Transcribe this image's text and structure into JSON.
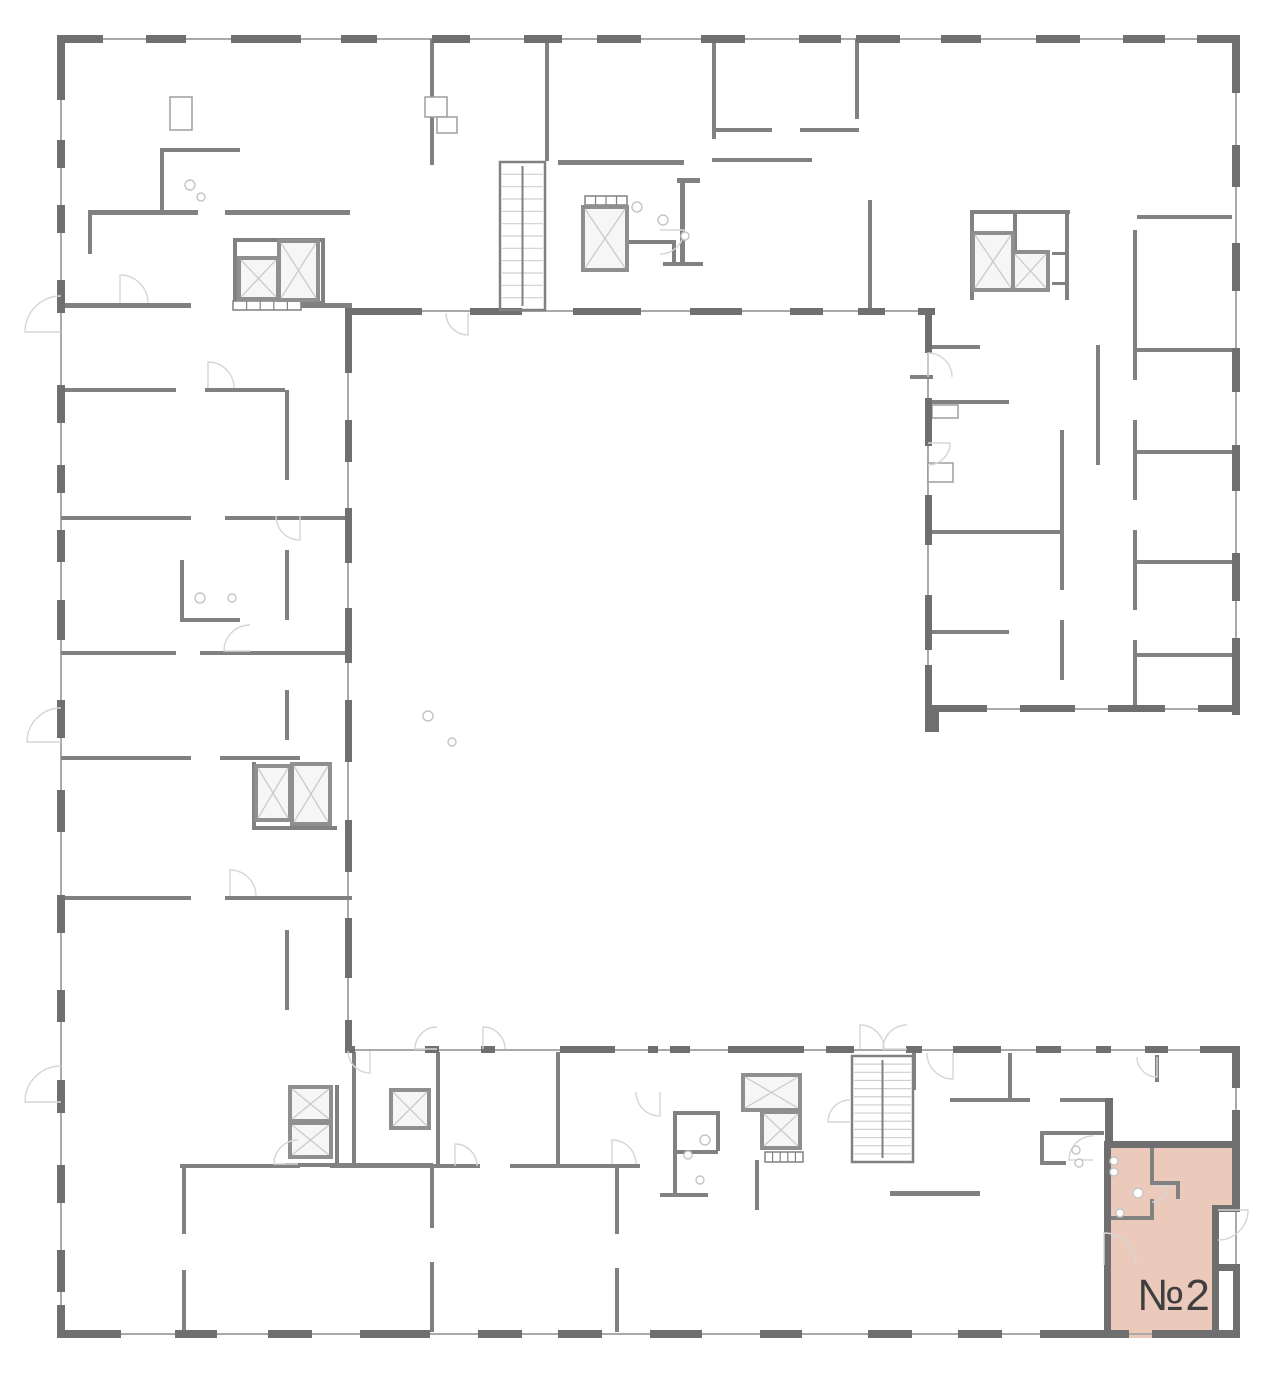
{
  "canvas": {
    "w": 1280,
    "h": 1374
  },
  "colors": {
    "bg": "#ffffff",
    "wall_dark": "#6f6f6f",
    "wall_medium": "#818181",
    "thin_line": "#a9a9a9",
    "arc": "#d6d6d6",
    "shaft_border": "#8f8f8f",
    "shaft_fill": "#f6f6f6",
    "shaft_x": "#cbcbcb",
    "box_line": "#9d9d9d",
    "tread": "#cfcfcf",
    "fixture": "#c4c4c4",
    "highlight_fill": "#ebcabc",
    "label_color": "#3f3f3f"
  },
  "unit": {
    "label": "№2",
    "polygon_points": "1104,1141 1240,1141 1240,1212 1216,1212 1216,1338 1104,1338",
    "label_x": 1174,
    "label_y": 1310,
    "font_size": 44
  },
  "thin_lines": [
    [
      57,
      39,
      1240,
      39
    ],
    [
      61,
      35,
      61,
      1338
    ],
    [
      57,
      1334,
      1240,
      1334
    ],
    [
      1236,
      35,
      1236,
      712
    ],
    [
      925,
      709,
      1240,
      709
    ],
    [
      348,
      308,
      348,
      1052
    ],
    [
      352,
      311,
      932,
      311
    ],
    [
      928,
      308,
      928,
      712
    ],
    [
      345,
      1050,
      1240,
      1050
    ],
    [
      1236,
      1046,
      1236,
      1338
    ]
  ],
  "dark_walls": [
    [
      57,
      35,
      46,
      8
    ],
    [
      146,
      35,
      40,
      8
    ],
    [
      231,
      35,
      70,
      8
    ],
    [
      341,
      35,
      36,
      8
    ],
    [
      432,
      35,
      38,
      8
    ],
    [
      524,
      35,
      38,
      8
    ],
    [
      597,
      35,
      44,
      8
    ],
    [
      701,
      35,
      44,
      8
    ],
    [
      799,
      35,
      42,
      8
    ],
    [
      856,
      35,
      44,
      8
    ],
    [
      941,
      35,
      40,
      8
    ],
    [
      1036,
      35,
      44,
      8
    ],
    [
      1123,
      35,
      42,
      8
    ],
    [
      1197,
      35,
      43,
      8
    ],
    [
      57,
      35,
      8,
      65
    ],
    [
      57,
      140,
      8,
      28
    ],
    [
      57,
      205,
      8,
      28
    ],
    [
      57,
      280,
      8,
      33
    ],
    [
      57,
      385,
      8,
      38
    ],
    [
      57,
      465,
      8,
      28
    ],
    [
      57,
      530,
      8,
      32
    ],
    [
      57,
      600,
      8,
      40
    ],
    [
      57,
      700,
      8,
      38
    ],
    [
      57,
      790,
      8,
      42
    ],
    [
      57,
      895,
      8,
      38
    ],
    [
      57,
      990,
      8,
      32
    ],
    [
      57,
      1080,
      8,
      33
    ],
    [
      57,
      1165,
      8,
      38
    ],
    [
      57,
      1250,
      8,
      42
    ],
    [
      57,
      1305,
      8,
      33
    ],
    [
      57,
      1330,
      64,
      8
    ],
    [
      175,
      1330,
      42,
      8
    ],
    [
      268,
      1330,
      44,
      8
    ],
    [
      360,
      1330,
      70,
      8
    ],
    [
      478,
      1330,
      44,
      8
    ],
    [
      558,
      1330,
      44,
      8
    ],
    [
      650,
      1330,
      52,
      8
    ],
    [
      760,
      1330,
      42,
      8
    ],
    [
      868,
      1330,
      44,
      8
    ],
    [
      958,
      1330,
      44,
      8
    ],
    [
      1040,
      1330,
      64,
      8
    ],
    [
      1104,
      1330,
      25,
      8
    ],
    [
      1152,
      1330,
      64,
      8
    ],
    [
      1216,
      1330,
      24,
      8
    ],
    [
      1232,
      35,
      8,
      58
    ],
    [
      1232,
      145,
      8,
      42
    ],
    [
      1232,
      243,
      8,
      48
    ],
    [
      1232,
      348,
      8,
      44
    ],
    [
      1232,
      445,
      8,
      46
    ],
    [
      1232,
      553,
      8,
      48
    ],
    [
      1232,
      638,
      8,
      77
    ],
    [
      925,
      705,
      62,
      7
    ],
    [
      1020,
      705,
      55,
      7
    ],
    [
      1108,
      705,
      57,
      7
    ],
    [
      1198,
      705,
      42,
      7
    ],
    [
      925,
      705,
      14,
      27
    ],
    [
      352,
      308,
      70,
      7
    ],
    [
      470,
      308,
      52,
      7
    ],
    [
      573,
      308,
      68,
      7
    ],
    [
      690,
      308,
      52,
      7
    ],
    [
      790,
      308,
      33,
      7
    ],
    [
      858,
      308,
      27,
      7
    ],
    [
      918,
      308,
      17,
      7
    ],
    [
      345,
      308,
      7,
      65
    ],
    [
      345,
      420,
      7,
      42
    ],
    [
      345,
      508,
      7,
      55
    ],
    [
      345,
      608,
      7,
      55
    ],
    [
      345,
      700,
      7,
      62
    ],
    [
      345,
      820,
      7,
      52
    ],
    [
      345,
      918,
      7,
      60
    ],
    [
      345,
      1020,
      7,
      32
    ],
    [
      925,
      308,
      7,
      45
    ],
    [
      925,
      398,
      7,
      48
    ],
    [
      925,
      495,
      7,
      50
    ],
    [
      925,
      595,
      7,
      55
    ],
    [
      925,
      665,
      7,
      47
    ],
    [
      345,
      1046,
      10,
      7
    ],
    [
      425,
      1046,
      14,
      7
    ],
    [
      481,
      1046,
      14,
      7
    ],
    [
      560,
      1046,
      55,
      7
    ],
    [
      648,
      1046,
      10,
      7
    ],
    [
      670,
      1046,
      20,
      7
    ],
    [
      728,
      1046,
      76,
      7
    ],
    [
      826,
      1046,
      28,
      7
    ],
    [
      906,
      1046,
      16,
      7
    ],
    [
      953,
      1046,
      48,
      7
    ],
    [
      1036,
      1046,
      25,
      7
    ],
    [
      1096,
      1046,
      15,
      7
    ],
    [
      1145,
      1046,
      23,
      7
    ],
    [
      1200,
      1046,
      38,
      7
    ],
    [
      1232,
      1046,
      8,
      42
    ],
    [
      1232,
      1110,
      8,
      31
    ],
    [
      1232,
      1141,
      8,
      68
    ],
    [
      1233,
      1264,
      7,
      74
    ],
    [
      1104,
      1141,
      7,
      197
    ],
    [
      1104,
      1141,
      136,
      7
    ],
    [
      1216,
      1205,
      24,
      7
    ],
    [
      1212,
      1205,
      7,
      133
    ],
    [
      1216,
      1264,
      22,
      7
    ],
    [
      1105,
      1098,
      8,
      47
    ]
  ],
  "medium_walls": [
    [
      430,
      39,
      4,
      126
    ],
    [
      545,
      39,
      4,
      122
    ],
    [
      558,
      160,
      126,
      5
    ],
    [
      680,
      178,
      5,
      84
    ],
    [
      677,
      178,
      23,
      5
    ],
    [
      663,
      262,
      40,
      4
    ],
    [
      672,
      240,
      4,
      24
    ],
    [
      625,
      240,
      48,
      4
    ],
    [
      712,
      39,
      4,
      100
    ],
    [
      712,
      128,
      60,
      4
    ],
    [
      800,
      128,
      59,
      4
    ],
    [
      712,
      158,
      100,
      4
    ],
    [
      855,
      39,
      4,
      80
    ],
    [
      868,
      200,
      4,
      110
    ],
    [
      88,
      210,
      110,
      5
    ],
    [
      225,
      210,
      125,
      5
    ],
    [
      88,
      210,
      4,
      44
    ],
    [
      160,
      148,
      80,
      4
    ],
    [
      160,
      148,
      4,
      64
    ],
    [
      61,
      303,
      130,
      5
    ],
    [
      248,
      303,
      104,
      5
    ],
    [
      61,
      388,
      115,
      4
    ],
    [
      205,
      388,
      80,
      4
    ],
    [
      61,
      516,
      130,
      4
    ],
    [
      225,
      516,
      127,
      4
    ],
    [
      61,
      651,
      115,
      4
    ],
    [
      200,
      651,
      152,
      4
    ],
    [
      61,
      756,
      130,
      4
    ],
    [
      220,
      756,
      80,
      4
    ],
    [
      61,
      896,
      130,
      4
    ],
    [
      225,
      896,
      127,
      4
    ],
    [
      285,
      390,
      4,
      90
    ],
    [
      285,
      550,
      4,
      70
    ],
    [
      285,
      690,
      4,
      50
    ],
    [
      285,
      930,
      4,
      80
    ],
    [
      233,
      238,
      90,
      4
    ],
    [
      233,
      238,
      4,
      67
    ],
    [
      321,
      238,
      4,
      67
    ],
    [
      233,
      301,
      90,
      4
    ],
    [
      252,
      762,
      4,
      66
    ],
    [
      252,
      826,
      85,
      4
    ],
    [
      180,
      560,
      4,
      60
    ],
    [
      180,
      618,
      60,
      4
    ],
    [
      932,
      345,
      48,
      4
    ],
    [
      910,
      375,
      23,
      4
    ],
    [
      929,
      400,
      80,
      4
    ],
    [
      929,
      530,
      131,
      4
    ],
    [
      929,
      630,
      80,
      4
    ],
    [
      1060,
      430,
      4,
      160
    ],
    [
      1060,
      620,
      4,
      60
    ],
    [
      1096,
      345,
      4,
      120
    ],
    [
      1133,
      230,
      4,
      150
    ],
    [
      1133,
      420,
      4,
      80
    ],
    [
      1133,
      530,
      4,
      80
    ],
    [
      1133,
      640,
      4,
      72
    ],
    [
      1137,
      215,
      95,
      4
    ],
    [
      1137,
      348,
      95,
      4
    ],
    [
      1137,
      450,
      95,
      4
    ],
    [
      1137,
      560,
      95,
      4
    ],
    [
      1137,
      653,
      95,
      4
    ],
    [
      970,
      210,
      100,
      4
    ],
    [
      970,
      210,
      4,
      90
    ],
    [
      1065,
      210,
      4,
      90
    ],
    [
      1013,
      210,
      4,
      40
    ],
    [
      1052,
      252,
      14,
      3
    ],
    [
      1052,
      282,
      14,
      3
    ],
    [
      352,
      1052,
      4,
      114
    ],
    [
      436,
      1052,
      4,
      114
    ],
    [
      556,
      1052,
      4,
      114
    ],
    [
      180,
      1164,
      120,
      4
    ],
    [
      330,
      1164,
      150,
      4
    ],
    [
      510,
      1164,
      130,
      4
    ],
    [
      182,
      1164,
      4,
      70
    ],
    [
      182,
      1270,
      4,
      62
    ],
    [
      430,
      1168,
      4,
      60
    ],
    [
      430,
      1262,
      4,
      70
    ],
    [
      615,
      1164,
      4,
      70
    ],
    [
      615,
      1268,
      4,
      64
    ],
    [
      673,
      1111,
      45,
      4
    ],
    [
      673,
      1111,
      4,
      86
    ],
    [
      673,
      1150,
      45,
      4
    ],
    [
      660,
      1193,
      48,
      4
    ],
    [
      716,
      1111,
      4,
      40
    ],
    [
      755,
      1160,
      4,
      50
    ],
    [
      890,
      1191,
      90,
      5
    ],
    [
      912,
      1053,
      4,
      37
    ],
    [
      335,
      1085,
      4,
      78
    ],
    [
      285,
      1163,
      148,
      4
    ],
    [
      950,
      1098,
      80,
      4
    ],
    [
      1060,
      1098,
      45,
      4
    ],
    [
      1008,
      1053,
      4,
      45
    ],
    [
      1040,
      1131,
      64,
      4
    ],
    [
      1040,
      1131,
      4,
      34
    ],
    [
      1040,
      1161,
      26,
      4
    ],
    [
      1155,
      1055,
      4,
      27
    ],
    [
      1150,
      1141,
      4,
      44
    ],
    [
      1150,
      1181,
      30,
      4
    ],
    [
      1176,
      1181,
      4,
      18
    ],
    [
      1104,
      1216,
      50,
      4
    ],
    [
      1150,
      1199,
      4,
      20
    ]
  ],
  "small_boxes": [
    [
      170,
      97,
      22,
      33
    ],
    [
      425,
      97,
      22,
      20
    ],
    [
      437,
      117,
      20,
      16
    ],
    [
      932,
      405,
      26,
      13
    ],
    [
      928,
      463,
      25,
      19
    ]
  ],
  "vents": [
    {
      "x": 585,
      "y": 196,
      "w": 42,
      "h": 9,
      "n": 4
    },
    {
      "x": 233,
      "y": 301,
      "w": 68,
      "h": 9,
      "n": 5
    },
    {
      "x": 765,
      "y": 1152,
      "w": 38,
      "h": 10,
      "n": 5
    }
  ],
  "elevators": [
    [
      239,
      258,
      39,
      41
    ],
    [
      279,
      241,
      39,
      59
    ],
    [
      583,
      207,
      44,
      63
    ],
    [
      973,
      233,
      40,
      57
    ],
    [
      1013,
      252,
      35,
      38
    ],
    [
      256,
      766,
      34,
      54
    ],
    [
      292,
      764,
      38,
      60
    ],
    [
      290,
      1087,
      41,
      34
    ],
    [
      290,
      1123,
      41,
      34
    ],
    [
      391,
      1090,
      38,
      38
    ],
    [
      743,
      1075,
      57,
      35
    ],
    [
      762,
      1112,
      38,
      36
    ]
  ],
  "stairs": [
    {
      "x": 500,
      "y": 162,
      "w": 45,
      "h": 148,
      "treads": 11
    },
    {
      "x": 852,
      "y": 1056,
      "w": 61,
      "h": 106,
      "treads": 12
    }
  ],
  "arcs": [
    [
      437,
      1049,
      22,
      180,
      270
    ],
    [
      483,
      1049,
      22,
      270,
      360
    ],
    [
      953,
      1053,
      26,
      90,
      180
    ],
    [
      1104,
      1265,
      32,
      270,
      360
    ],
    [
      1218,
      1210,
      30,
      0,
      90
    ],
    [
      1152,
      1186,
      16,
      0,
      90
    ],
    [
      61,
      332,
      36,
      180,
      270
    ],
    [
      61,
      742,
      34,
      180,
      270
    ],
    [
      61,
      1102,
      36,
      180,
      270
    ],
    [
      928,
      377,
      24,
      270,
      360
    ],
    [
      928,
      443,
      22,
      0,
      90
    ],
    [
      298,
      1164,
      24,
      180,
      270
    ],
    [
      455,
      1166,
      22,
      270,
      360
    ],
    [
      612,
      1164,
      24,
      270,
      360
    ],
    [
      660,
      1092,
      24,
      90,
      180
    ],
    [
      850,
      1122,
      22,
      180,
      270
    ],
    [
      1093,
      1160,
      24,
      180,
      270
    ],
    [
      208,
      388,
      26,
      270,
      360
    ],
    [
      250,
      651,
      26,
      180,
      270
    ],
    [
      230,
      896,
      26,
      270,
      360
    ],
    [
      300,
      516,
      24,
      90,
      180
    ],
    [
      660,
      230,
      24,
      0,
      90
    ],
    [
      120,
      303,
      28,
      270,
      360
    ],
    [
      1157,
      1057,
      20,
      90,
      180
    ],
    [
      860,
      1049,
      24,
      270,
      360
    ],
    [
      907,
      1049,
      24,
      180,
      270
    ],
    [
      370,
      1051,
      22,
      90,
      180
    ],
    [
      468,
      313,
      22,
      90,
      180
    ]
  ],
  "fixtures": [
    [
      190,
      185,
      5
    ],
    [
      201,
      197,
      4
    ],
    [
      637,
      207,
      5
    ],
    [
      663,
      220,
      5
    ],
    [
      685,
      236,
      4
    ],
    [
      200,
      598,
      5
    ],
    [
      232,
      598,
      4
    ],
    [
      428,
      716,
      5
    ],
    [
      452,
      742,
      4
    ],
    [
      705,
      1140,
      5
    ],
    [
      688,
      1155,
      4
    ],
    [
      700,
      1180,
      4
    ],
    [
      1076,
      1150,
      4
    ],
    [
      1079,
      1163,
      4
    ],
    [
      1114,
      1161,
      4
    ],
    [
      1114,
      1172,
      4
    ],
    [
      1138,
      1193,
      5
    ],
    [
      1120,
      1213,
      4
    ]
  ]
}
